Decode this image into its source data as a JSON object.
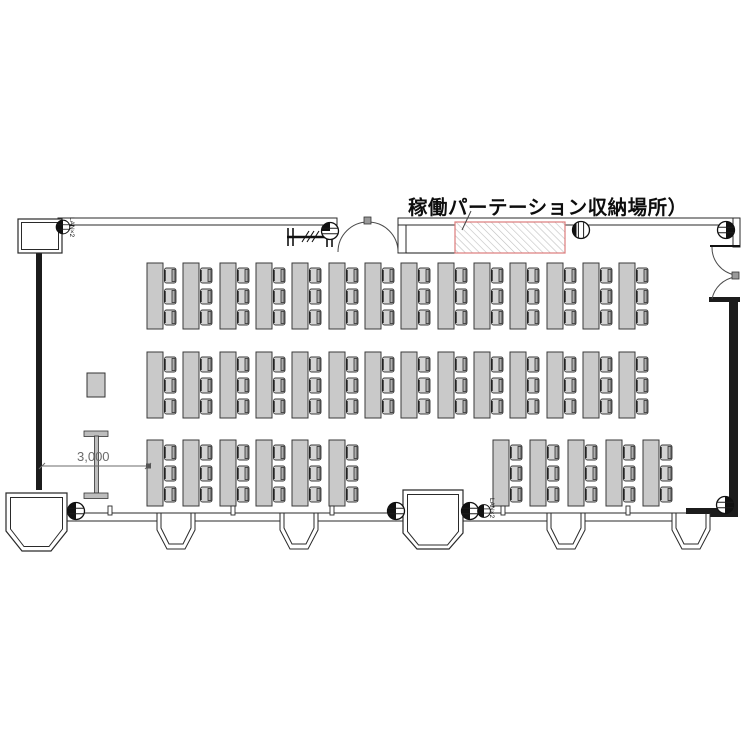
{
  "labels": {
    "partition_storage": "稼働パーテーション収納場所）",
    "dimension": "3,000",
    "lan_top": "LAN×2",
    "lan_bottom": "LAN×2"
  },
  "colors": {
    "wall": "#1c1c1c",
    "line": "#2a2a2a",
    "table_fill": "#c9c9c9",
    "chair_fill": "#d4d4d4",
    "chair_back": "#aeaeae",
    "storage_hatch_border": "#dd7b7b",
    "storage_hatch_line": "#c0c0c0",
    "dimension_gray": "#6b6b6b"
  },
  "furniture": {
    "table": {
      "width": 16,
      "height": 66,
      "chairs_per_table": 3
    },
    "chair": {
      "width": 13,
      "height": 16,
      "y_offsets": [
        4.5,
        25.5,
        46.5
      ]
    },
    "rows": [
      {
        "name": "row-1",
        "y": 263,
        "xs": [
          147,
          183,
          220,
          256,
          292,
          329,
          365,
          401,
          438,
          474,
          510,
          547,
          583,
          619
        ]
      },
      {
        "name": "row-2",
        "y": 352,
        "xs": [
          147,
          183,
          220,
          256,
          292,
          329,
          365,
          401,
          438,
          474,
          510,
          547,
          583,
          619
        ]
      },
      {
        "name": "row-3",
        "y": 440,
        "xs": [
          147,
          183,
          220,
          256,
          292,
          329,
          493,
          530,
          568,
          606,
          643
        ]
      }
    ]
  },
  "fixtures": {
    "outlets": [
      {
        "name": "lan-outlet-top-left",
        "type": "outlet-l",
        "x": 63,
        "y": 227,
        "scale": 0.8
      },
      {
        "name": "outlet-door-track",
        "type": "outlet-q",
        "x": 330,
        "y": 231,
        "scale": 1
      },
      {
        "name": "column-marker-top",
        "type": "outlet-v",
        "x": 581,
        "y": 230,
        "scale": 1
      },
      {
        "name": "outlet-top-right",
        "type": "outlet-r",
        "x": 726,
        "y": 230,
        "scale": 1
      },
      {
        "name": "outlet-bottom-left",
        "type": "outlet-l",
        "x": 76,
        "y": 511,
        "scale": 1
      },
      {
        "name": "outlet-entrance-left",
        "type": "outlet-l",
        "x": 396,
        "y": 511,
        "scale": 1
      },
      {
        "name": "outlet-entrance-right",
        "type": "outlet-l",
        "x": 470,
        "y": 511,
        "scale": 1
      },
      {
        "name": "lan-outlet-bottom",
        "type": "outlet-l",
        "x": 484,
        "y": 511,
        "scale": 0.75
      },
      {
        "name": "outlet-bottom-right",
        "type": "outlet-r",
        "x": 725,
        "y": 505,
        "scale": 1
      }
    ],
    "wall_ticks": [
      110,
      233,
      332,
      503,
      628
    ],
    "bay_centers": [
      176,
      299,
      566,
      691
    ]
  }
}
